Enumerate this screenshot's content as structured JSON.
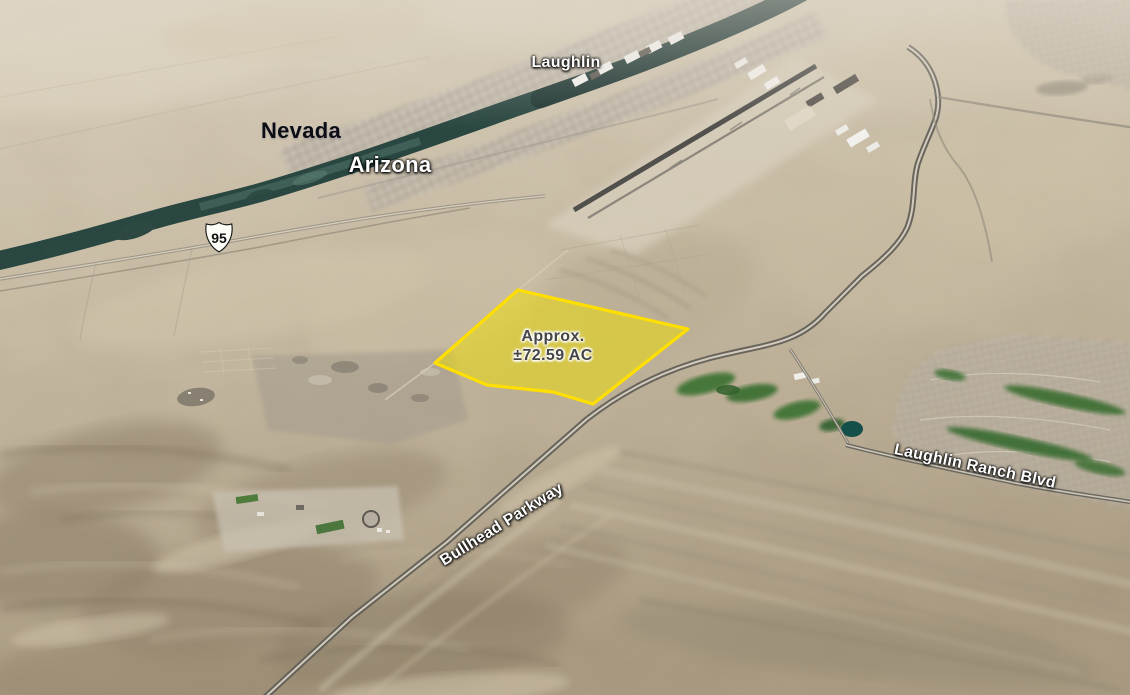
{
  "map": {
    "labels": {
      "city": "Laughlin",
      "state_nevada": "Nevada",
      "state_arizona": "Arizona",
      "route_shield": "95",
      "road_bullhead": "Bullhead Parkway",
      "road_laughlin_ranch": "Laughlin Ranch Blvd"
    },
    "parcel": {
      "line1": "Approx.",
      "line2": "±72.59 AC",
      "outline_color": "#ffdf00",
      "fill_color": "#f0e000"
    },
    "colors": {
      "river": "#24423c",
      "desert_light": "#d8cdb8",
      "desert_shadow": "#8a7a64",
      "golf_green": "#356b2c",
      "road_casing": "#5b5952"
    }
  }
}
